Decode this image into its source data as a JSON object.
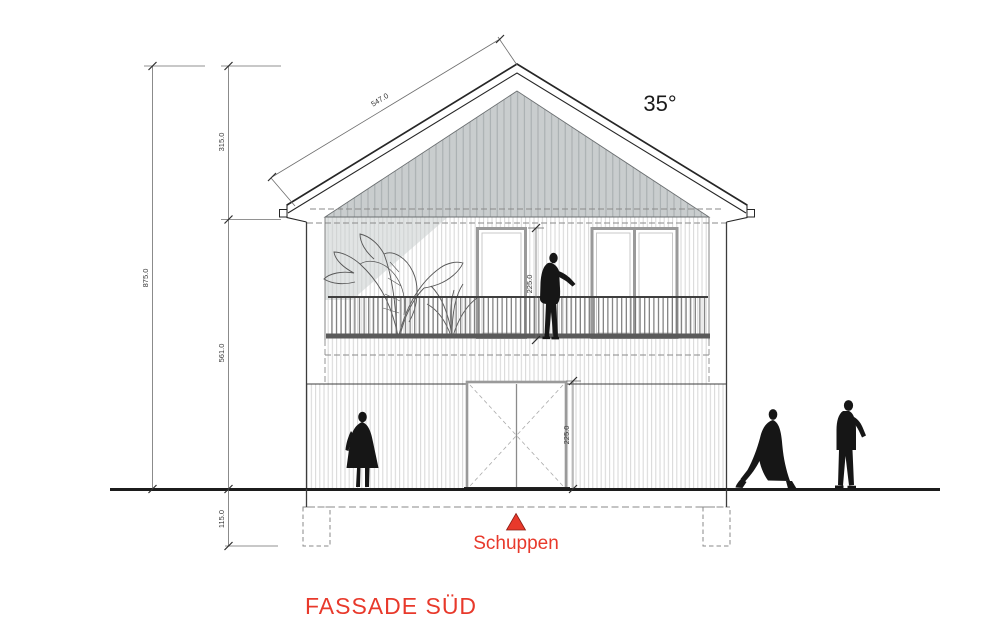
{
  "drawing": {
    "title": "FASSADE SÜD",
    "shed_label": "Schuppen",
    "roof_angle": "35°",
    "dims": {
      "roof_slope_length": "547.0",
      "roof_height": "315.0",
      "total_height": "875.0",
      "wall_height": "561.0",
      "foundation_depth": "115.0",
      "upper_door_height": "225.0",
      "shed_door_height": "225.0"
    },
    "colors": {
      "accent_red": "#e8392b",
      "shadow_gray": "#c9cdce"
    }
  }
}
